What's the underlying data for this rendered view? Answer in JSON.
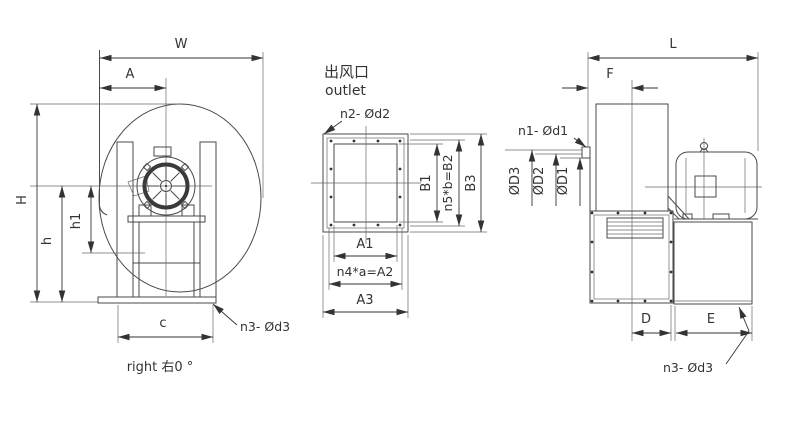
{
  "drawing": {
    "background": "#ffffff",
    "line_color": "#4a4a4a",
    "text_color": "#333333",
    "front_view": {
      "dim_W": "W",
      "dim_A": "A",
      "dim_H": "H",
      "dim_h": "h",
      "dim_h1": "h1",
      "dim_c": "c",
      "leader_n3": "n3- Ød3",
      "caption": "right 右0 °"
    },
    "outlet_view": {
      "title_cn": "出风口",
      "title_en": "outlet",
      "leader_n2": "n2- Ød2",
      "dim_B1": "B1",
      "dim_B2": "n5*b=B2",
      "dim_B3": "B3",
      "dim_A1": "A1",
      "dim_A2": "n4*a=A2",
      "dim_A3": "A3"
    },
    "side_view": {
      "dim_L": "L",
      "dim_F": "F",
      "leader_n1": "n1- Ød1",
      "dim_OD3": "ØD3",
      "dim_OD2": "ØD2",
      "dim_OD1": "ØD1",
      "dim_D": "D",
      "dim_E": "E",
      "leader_n3": "n3- Ød3"
    }
  }
}
